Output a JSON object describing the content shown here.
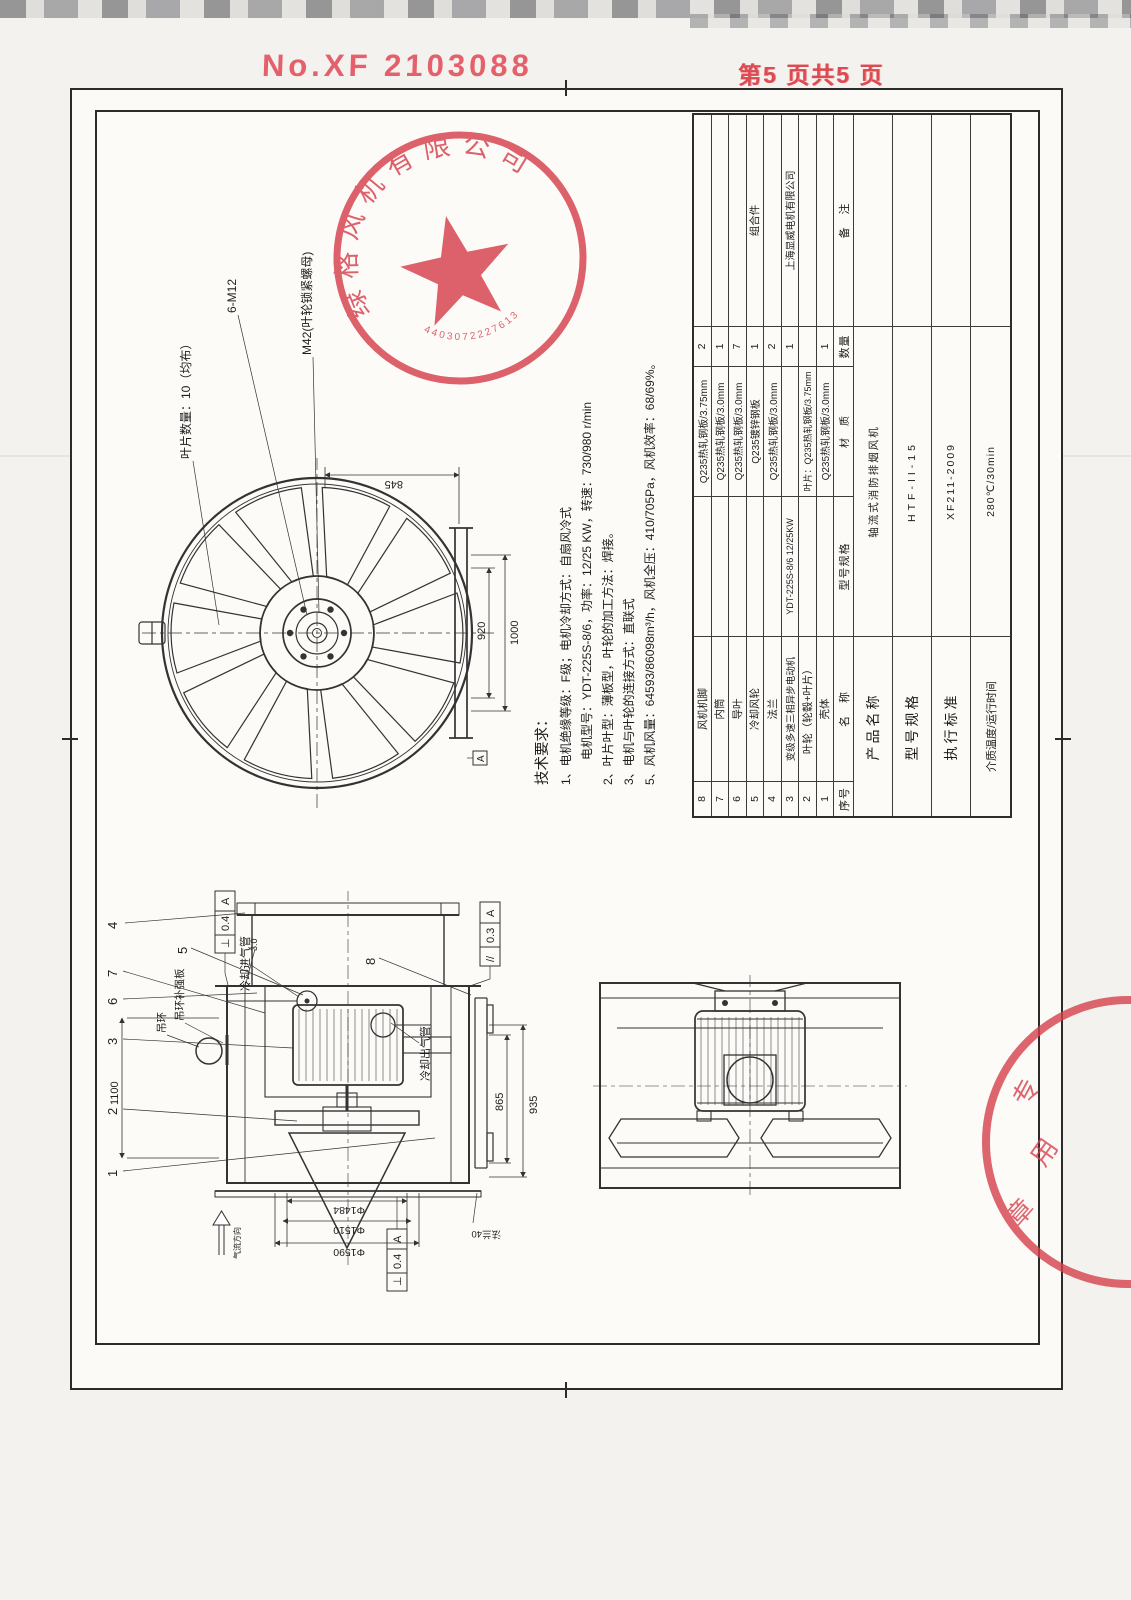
{
  "header": {
    "doc_no": "No.XF 2103088",
    "page_info": "第5 页共5 页"
  },
  "stamps": {
    "main_ring_text": "绿格风机有限公司",
    "main_number": "4403072227613",
    "corner_chars": [
      "专",
      "用",
      "章"
    ],
    "red": "#d5404c"
  },
  "tech": {
    "title": "技术要求：",
    "lines": [
      "1、电机绝缘等级：F级；电机冷却方式：自扇风冷式",
      "电机型号：YDT-225S-8/6，功率：12/25 KW，转速：730/980 r/min",
      "2、叶片叶型：薄板型，叶轮的加工方法：焊接。",
      "3、电机与叶轮的连接方式：直联式",
      "5、风机风量：64593/86098m³/h，风机全压：410/705Pa，风机效率：68/69%。"
    ]
  },
  "front_view": {
    "label_blade_count": "叶片数量：10（均布）",
    "label_bolt": "6-M12",
    "label_nut": "M42(叶轮锁紧螺母)",
    "dim_845": "845",
    "dim_920": "920",
    "dim_1000": "1000"
  },
  "side_view": {
    "dim_length": "1100",
    "dim_865": "865",
    "dim_935": "935",
    "dim_d1484": "Φ1484",
    "dim_d1510": "Φ1510",
    "dim_d1590": "Φ1590",
    "dim_thickness": "3.0",
    "label_cooling_inlet": "冷却进气管",
    "label_cooling_outlet": "冷却出气管",
    "label_lifting_ring": "吊环",
    "label_ring_plate": "吊环补强板",
    "label_airflow": "气流方向",
    "label_flange40": "法兰40",
    "callouts": [
      "1",
      "2",
      "3",
      "4",
      "5",
      "6",
      "7",
      "8"
    ],
    "gdt1": {
      "symbol": "⊥",
      "value": "0.4",
      "datum": "A"
    },
    "gdt2": {
      "symbol": "//",
      "value": "0.3",
      "datum": "A"
    },
    "gdt3": {
      "symbol": "⊥",
      "value": "0.4",
      "datum": "A"
    },
    "datum_label": "A"
  },
  "bom": {
    "headers": [
      "序号",
      "名　称",
      "型号规格",
      "材　质",
      "数量",
      "备　注"
    ],
    "rows": [
      {
        "no": "8",
        "name": "风机机脚",
        "spec": "",
        "material": "Q235热轧钢板/3.75mm",
        "qty": "2",
        "note": ""
      },
      {
        "no": "7",
        "name": "内筒",
        "spec": "",
        "material": "Q235热轧钢板/3.0mm",
        "qty": "1",
        "note": ""
      },
      {
        "no": "6",
        "name": "导叶",
        "spec": "",
        "material": "Q235热轧钢板/3.0mm",
        "qty": "7",
        "note": ""
      },
      {
        "no": "5",
        "name": "冷却风轮",
        "spec": "",
        "material": "Q235镀锌钢板",
        "qty": "1",
        "note": "组合件"
      },
      {
        "no": "4",
        "name": "法兰",
        "spec": "",
        "material": "Q235热轧钢板/3.0mm",
        "qty": "2",
        "note": ""
      },
      {
        "no": "3",
        "name": "变级多速三相异步电动机",
        "spec": "YDT-225S-8/6 12/25KW",
        "material": "",
        "qty": "1",
        "note": "上海显威电机有限公司"
      },
      {
        "no": "2",
        "name": "叶轮（轮毂+叶片）",
        "spec": "",
        "material": "叶片：Q235热轧钢板/3.75mm",
        "qty": "",
        "note": ""
      },
      {
        "no": "1",
        "name": "壳体",
        "spec": "",
        "material": "Q235热轧钢板/3.0mm",
        "qty": "1",
        "note": ""
      }
    ],
    "title_rows": [
      {
        "label": "产品名称",
        "value": "轴流式消防排烟风机"
      },
      {
        "label": "型号规格",
        "value": "HTF-II-15"
      },
      {
        "label": "执行标准",
        "value": "XF211-2009"
      },
      {
        "label": "介质温度/运行时间",
        "value": "280℃/30min"
      }
    ]
  }
}
